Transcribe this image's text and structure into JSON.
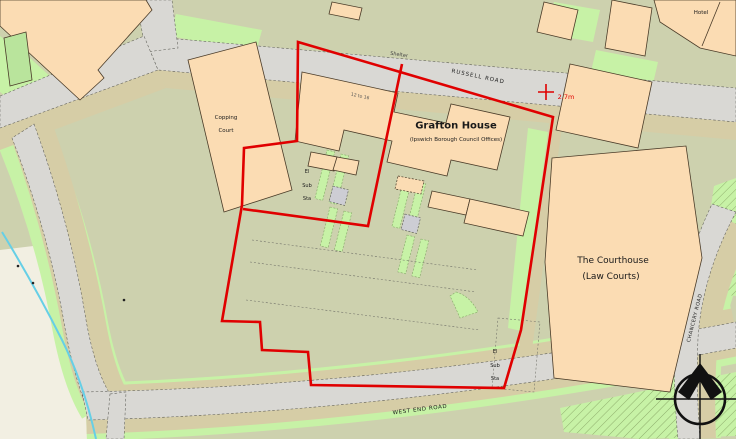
{
  "map": {
    "labels": {
      "grafton_house": "Grafton House",
      "grafton_house_subtitle": "(Ipswich Borough Council Offices)",
      "courthouse_line1": "The Courthouse",
      "courthouse_line2": "(Law Courts)",
      "copping_court_line1": "Copping",
      "copping_court_line2": "Court",
      "hotel": "Hotel",
      "shelter": "Shelter",
      "russell_road": "RUSSELL ROAD",
      "west_end_road": "WEST END ROAD",
      "chancery_road": "CHANCERY ROAD",
      "el_sub_sta_line1": "El",
      "el_sub_sta_line2": "Sub",
      "el_sub_sta_line3": "Sta",
      "building_range": "12 to 16",
      "spot_height": "2.7m"
    },
    "colors": {
      "site_boundary": "#e00000",
      "building": "#fbdcb3",
      "land": "#cdd1ae",
      "road": "#d9d8d4",
      "road_verge": "#d6cda6",
      "vegetation": "#c7f2a6",
      "water": "#66cfe6"
    }
  }
}
